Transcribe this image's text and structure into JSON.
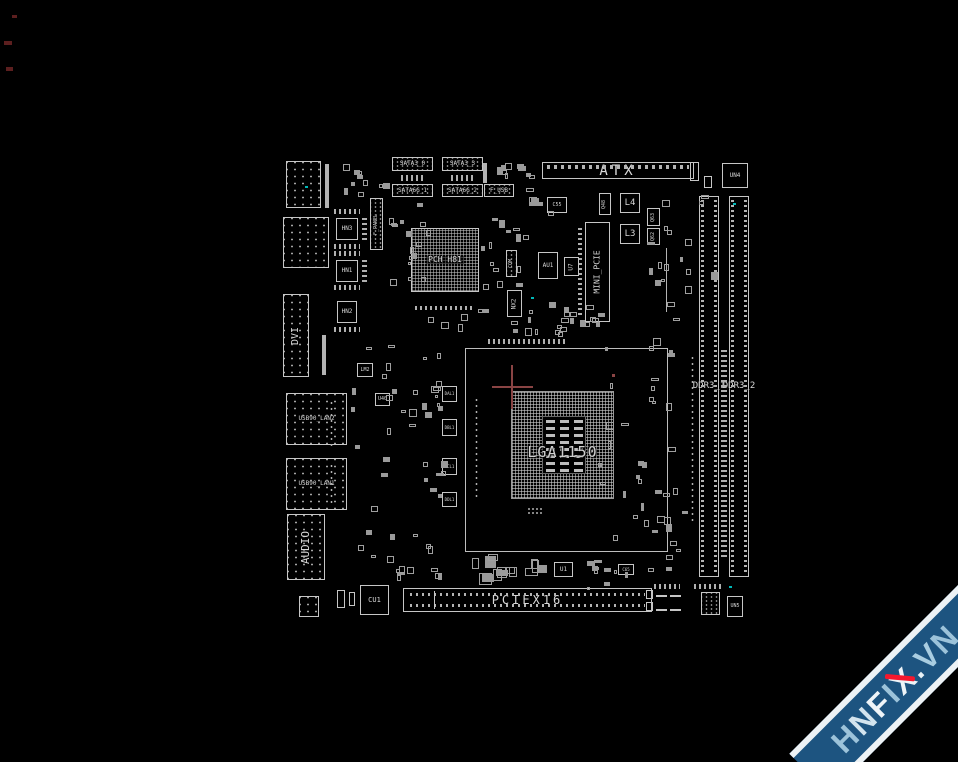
{
  "meta": {
    "background": "#000000",
    "line_color": "#c6c6c6",
    "text_color": "#d8d8d8",
    "teal_indicator_color": "#00b8b8",
    "crosshair_color": "#8a4444",
    "edge_mark_color": "#5c1f1f"
  },
  "watermark": {
    "band_color": "#1d5480",
    "edge_color": "#edf2f5",
    "slash_color": "#f5182e",
    "parts": [
      {
        "t": "H",
        "c": "#9cc3da"
      },
      {
        "t": "N",
        "c": "#d3e4ee"
      },
      {
        "t": "F",
        "c": "#eef4f8"
      },
      {
        "t": "I",
        "c": "#9cc3da"
      },
      {
        "t": "X",
        "c": "#eef4f8",
        "slash": true
      },
      {
        "t": ".",
        "c": "#e8f1f6"
      },
      {
        "t": "V",
        "c": "#a9cde1"
      },
      {
        "t": "N",
        "c": "#9cc3da"
      }
    ]
  },
  "socket": {
    "label": "LGA1150",
    "outline": {
      "x": 465,
      "y": 348,
      "w": 203,
      "h": 204
    },
    "grid": {
      "x": 511,
      "y": 391,
      "w": 103,
      "h": 108
    },
    "cavity": {
      "x": 542,
      "y": 416,
      "w": 44,
      "h": 58
    },
    "cap_cols": 3,
    "cap_rows": 8,
    "crosshair": {
      "x": 512,
      "y": 387
    },
    "red_dot": {
      "x": 612,
      "y": 374
    }
  },
  "indicator_dots": [
    {
      "x": 305,
      "y": 186
    },
    {
      "x": 733,
      "y": 203
    },
    {
      "x": 531,
      "y": 297
    },
    {
      "x": 729,
      "y": 586
    }
  ],
  "edge_marks": [
    {
      "x": 4,
      "y": 41,
      "w": 8,
      "h": 4
    },
    {
      "x": 6,
      "y": 67,
      "w": 7,
      "h": 4
    },
    {
      "x": 12,
      "y": 15,
      "w": 5,
      "h": 3
    }
  ],
  "components": [
    {
      "n": "io-grid-connector",
      "k": "port",
      "x": 286,
      "y": 161,
      "w": 35,
      "h": 47
    },
    {
      "n": "io-port-upper",
      "k": "port",
      "x": 283,
      "y": 217,
      "w": 46,
      "h": 51
    },
    {
      "n": "dvi-port",
      "k": "port",
      "x": 283,
      "y": 294,
      "w": 26,
      "h": 83,
      "t": "DVI",
      "o": "v",
      "fs": 10
    },
    {
      "n": "usb-lan2-port",
      "k": "port",
      "x": 286,
      "y": 393,
      "w": 61,
      "h": 52,
      "t": "USB90_LAN2",
      "fs": 6
    },
    {
      "n": "usb-lan1-port",
      "k": "port",
      "x": 286,
      "y": 458,
      "w": 61,
      "h": 52,
      "t": "USB90_LAN1",
      "fs": 6
    },
    {
      "n": "audio-port",
      "k": "port",
      "x": 287,
      "y": 514,
      "w": 38,
      "h": 66,
      "t": "AUDIO",
      "o": "v",
      "fs": 11
    },
    {
      "n": "crystal",
      "k": "port",
      "x": 299,
      "y": 596,
      "w": 20,
      "h": 21
    },
    {
      "n": "chip-hn3",
      "k": "label",
      "x": 336,
      "y": 218,
      "w": 22,
      "h": 22,
      "t": "HN3",
      "fs": 6
    },
    {
      "n": "chip-hn1",
      "k": "label",
      "x": 336,
      "y": 260,
      "w": 22,
      "h": 22,
      "t": "HN1",
      "fs": 6
    },
    {
      "n": "chip-hn2",
      "k": "label",
      "x": 337,
      "y": 301,
      "w": 20,
      "h": 22,
      "t": "HN2",
      "fs": 6
    },
    {
      "n": "pin-row",
      "k": "hstrip",
      "x": 334,
      "y": 209,
      "w": 26,
      "h": 5
    },
    {
      "n": "pin-row",
      "k": "hstrip",
      "x": 334,
      "y": 244,
      "w": 26,
      "h": 5
    },
    {
      "n": "pin-row",
      "k": "hstrip",
      "x": 334,
      "y": 251,
      "w": 26,
      "h": 5
    },
    {
      "n": "pin-row",
      "k": "hstrip",
      "x": 334,
      "y": 285,
      "w": 26,
      "h": 5
    },
    {
      "n": "pin-row",
      "k": "hstrip",
      "x": 334,
      "y": 327,
      "w": 26,
      "h": 5
    },
    {
      "n": "pin-col",
      "k": "vstrip",
      "x": 362,
      "y": 218,
      "w": 5,
      "h": 22
    },
    {
      "n": "pin-col",
      "k": "vstrip",
      "x": 362,
      "y": 260,
      "w": 5,
      "h": 22
    },
    {
      "n": "front-panel-header",
      "k": "conn",
      "x": 370,
      "y": 198,
      "w": 13,
      "h": 52,
      "t": "F_PANEL",
      "o": "v",
      "fs": 5
    },
    {
      "n": "component-bar",
      "k": "bar",
      "x": 325,
      "y": 164,
      "w": 4,
      "h": 44
    },
    {
      "n": "component-bar",
      "k": "bar",
      "x": 322,
      "y": 335,
      "w": 4,
      "h": 40
    },
    {
      "n": "pin-col",
      "k": "dotv",
      "x": 329,
      "y": 400,
      "w": 5,
      "h": 47
    },
    {
      "n": "pin-col",
      "k": "dotv",
      "x": 329,
      "y": 463,
      "w": 5,
      "h": 40
    },
    {
      "n": "sata3-0-connector",
      "k": "conn",
      "x": 392,
      "y": 157,
      "w": 41,
      "h": 14,
      "t": "SATA3_0",
      "fs": 6
    },
    {
      "n": "sata3-3-connector",
      "k": "conn",
      "x": 442,
      "y": 157,
      "w": 41,
      "h": 14,
      "t": "SATA3_3",
      "fs": 6
    },
    {
      "n": "sata6g-1-connector",
      "k": "conn",
      "x": 392,
      "y": 184,
      "w": 41,
      "h": 13,
      "t": "SATA6G_1",
      "fs": 6
    },
    {
      "n": "sata6g-2-connector",
      "k": "conn",
      "x": 442,
      "y": 184,
      "w": 41,
      "h": 13,
      "t": "SATA6G_2",
      "fs": 6
    },
    {
      "n": "pin-row",
      "k": "hstrip",
      "x": 401,
      "y": 175,
      "w": 22,
      "h": 6
    },
    {
      "n": "pin-row",
      "k": "hstrip",
      "x": 451,
      "y": 175,
      "w": 22,
      "h": 6
    },
    {
      "n": "component-bar",
      "k": "bar",
      "x": 483,
      "y": 163,
      "w": 4,
      "h": 20
    },
    {
      "n": "f-usb-header",
      "k": "conn",
      "x": 484,
      "y": 184,
      "w": 30,
      "h": 13,
      "t": "F_USB",
      "fs": 6
    },
    {
      "n": "atx-power-connector",
      "k": "atx",
      "x": 542,
      "y": 162,
      "w": 152,
      "h": 17,
      "t": "ATX",
      "fs": 14
    },
    {
      "n": "chip-un4",
      "k": "label",
      "x": 722,
      "y": 163,
      "w": 26,
      "h": 25,
      "t": "UN4",
      "fs": 6
    },
    {
      "n": "cap-c55",
      "k": "label",
      "x": 547,
      "y": 197,
      "w": 20,
      "h": 16,
      "t": "C55",
      "fs": 5
    },
    {
      "n": "mosfet-q48",
      "k": "label",
      "x": 599,
      "y": 193,
      "w": 12,
      "h": 22,
      "t": "Q48",
      "o": "v",
      "fs": 5
    },
    {
      "n": "inductor-l4",
      "k": "label",
      "x": 620,
      "y": 193,
      "w": 20,
      "h": 20,
      "t": "L4",
      "fs": 9
    },
    {
      "n": "inductor-l3",
      "k": "label",
      "x": 620,
      "y": 224,
      "w": 20,
      "h": 20,
      "t": "L3",
      "fs": 9
    },
    {
      "n": "mosfet-q63",
      "k": "label",
      "x": 647,
      "y": 208,
      "w": 13,
      "h": 18,
      "t": "Q63",
      "o": "v",
      "fs": 5
    },
    {
      "n": "mosfet-q62",
      "k": "label",
      "x": 647,
      "y": 228,
      "w": 13,
      "h": 17,
      "t": "Q62",
      "o": "v",
      "fs": 5
    },
    {
      "n": "small-box",
      "k": "plain",
      "x": 690,
      "y": 162,
      "w": 9,
      "h": 19
    },
    {
      "n": "small-box",
      "k": "plain",
      "x": 704,
      "y": 176,
      "w": 8,
      "h": 12
    },
    {
      "n": "pch-bga",
      "k": "bga",
      "x": 411,
      "y": 228,
      "w": 68,
      "h": 64,
      "t": "PCH H81",
      "fs": 8
    },
    {
      "n": "pin-row",
      "k": "hstrip",
      "x": 415,
      "y": 306,
      "w": 60,
      "h": 4
    },
    {
      "n": "mini-pcie-slot",
      "k": "plain",
      "x": 585,
      "y": 222,
      "w": 25,
      "h": 100,
      "t": "MINI_PCIE",
      "o": "v",
      "fs": 8
    },
    {
      "n": "pin-col",
      "k": "vstrip",
      "x": 578,
      "y": 228,
      "w": 4,
      "h": 90
    },
    {
      "n": "com-header",
      "k": "conn",
      "x": 506,
      "y": 250,
      "w": 11,
      "h": 27,
      "t": "COM",
      "o": "v",
      "fs": 5
    },
    {
      "n": "chip-au1",
      "k": "label",
      "x": 538,
      "y": 252,
      "w": 20,
      "h": 27,
      "t": "AU1",
      "fs": 6
    },
    {
      "n": "chip-u7",
      "k": "label",
      "x": 564,
      "y": 257,
      "w": 15,
      "h": 19,
      "t": "U7",
      "o": "v",
      "fs": 6
    },
    {
      "n": "chip-nx2",
      "k": "label",
      "x": 507,
      "y": 290,
      "w": 15,
      "h": 27,
      "t": "NX2",
      "o": "v",
      "fs": 6
    },
    {
      "n": "trace-line",
      "k": "bar",
      "x": 666,
      "y": 248,
      "w": 1,
      "h": 64
    },
    {
      "n": "chip-lm2",
      "k": "label",
      "x": 357,
      "y": 363,
      "w": 16,
      "h": 14,
      "t": "LM2",
      "fs": 5
    },
    {
      "n": "chip-u40",
      "k": "label",
      "x": 375,
      "y": 393,
      "w": 15,
      "h": 13,
      "t": "U40",
      "fs": 5
    },
    {
      "n": "driver-dal1",
      "k": "label",
      "x": 442,
      "y": 386,
      "w": 15,
      "h": 16,
      "t": "DAL1",
      "fs": 4
    },
    {
      "n": "driver-dbl1",
      "k": "label",
      "x": 442,
      "y": 419,
      "w": 15,
      "h": 17,
      "t": "DBL1",
      "fs": 4
    },
    {
      "n": "driver-dcl1",
      "k": "label",
      "x": 442,
      "y": 458,
      "w": 15,
      "h": 17,
      "t": "DCL1",
      "fs": 4
    },
    {
      "n": "driver-ddl1",
      "k": "label",
      "x": 442,
      "y": 492,
      "w": 15,
      "h": 15,
      "t": "DDL1",
      "fs": 4
    },
    {
      "n": "pad-cluster",
      "k": "dots",
      "x": 527,
      "y": 507,
      "w": 17,
      "h": 9
    },
    {
      "n": "pin-row",
      "k": "hstrip",
      "x": 488,
      "y": 339,
      "w": 77,
      "h": 5
    },
    {
      "n": "pin-col",
      "k": "dotv",
      "x": 474,
      "y": 397,
      "w": 6,
      "h": 103
    },
    {
      "n": "ddr3-1-slot",
      "k": "ddr",
      "x": 699,
      "y": 196,
      "w": 20,
      "h": 381,
      "t": "DDR3_1",
      "fs": 9
    },
    {
      "n": "ddr3-2-slot",
      "k": "ddr",
      "x": 729,
      "y": 196,
      "w": 20,
      "h": 381,
      "t": "DDR3_2",
      "fs": 9
    },
    {
      "n": "pin-col",
      "k": "dotv",
      "x": 690,
      "y": 355,
      "w": 5,
      "h": 170
    },
    {
      "n": "pin-col",
      "k": "vstrip",
      "x": 721,
      "y": 350,
      "w": 6,
      "h": 210
    },
    {
      "n": "pin-row",
      "k": "hstrip",
      "x": 694,
      "y": 584,
      "w": 30,
      "h": 5
    },
    {
      "n": "pciex16-slot",
      "k": "pcie",
      "x": 403,
      "y": 588,
      "w": 249,
      "h": 24,
      "t": "PCIEX16",
      "fs": 12
    },
    {
      "n": "chip-cu1",
      "k": "label",
      "x": 360,
      "y": 585,
      "w": 29,
      "h": 30,
      "t": "CU1",
      "fs": 7
    },
    {
      "n": "chip-u1",
      "k": "label",
      "x": 554,
      "y": 562,
      "w": 19,
      "h": 15,
      "t": "U1",
      "fs": 6
    },
    {
      "n": "cap-c65",
      "k": "label",
      "x": 618,
      "y": 564,
      "w": 16,
      "h": 11,
      "t": "C65",
      "fs": 4
    },
    {
      "n": "atx12v-connector",
      "k": "quad",
      "x": 656,
      "y": 590,
      "w": 25,
      "h": 26
    },
    {
      "n": "pin-row",
      "k": "hstrip",
      "x": 654,
      "y": 584,
      "w": 26,
      "h": 5
    },
    {
      "n": "small-box",
      "k": "plain",
      "x": 646,
      "y": 590,
      "w": 7,
      "h": 9
    },
    {
      "n": "small-box",
      "k": "plain",
      "x": 646,
      "y": 602,
      "w": 7,
      "h": 9
    },
    {
      "n": "header-box",
      "k": "conn",
      "x": 701,
      "y": 592,
      "w": 19,
      "h": 23
    },
    {
      "n": "chip-un5",
      "k": "label",
      "x": 727,
      "y": 596,
      "w": 16,
      "h": 21,
      "t": "UN5",
      "fs": 5
    },
    {
      "n": "small-box",
      "k": "plain",
      "x": 337,
      "y": 590,
      "w": 8,
      "h": 18
    },
    {
      "n": "small-box",
      "k": "plain",
      "x": 349,
      "y": 592,
      "w": 6,
      "h": 14
    }
  ]
}
